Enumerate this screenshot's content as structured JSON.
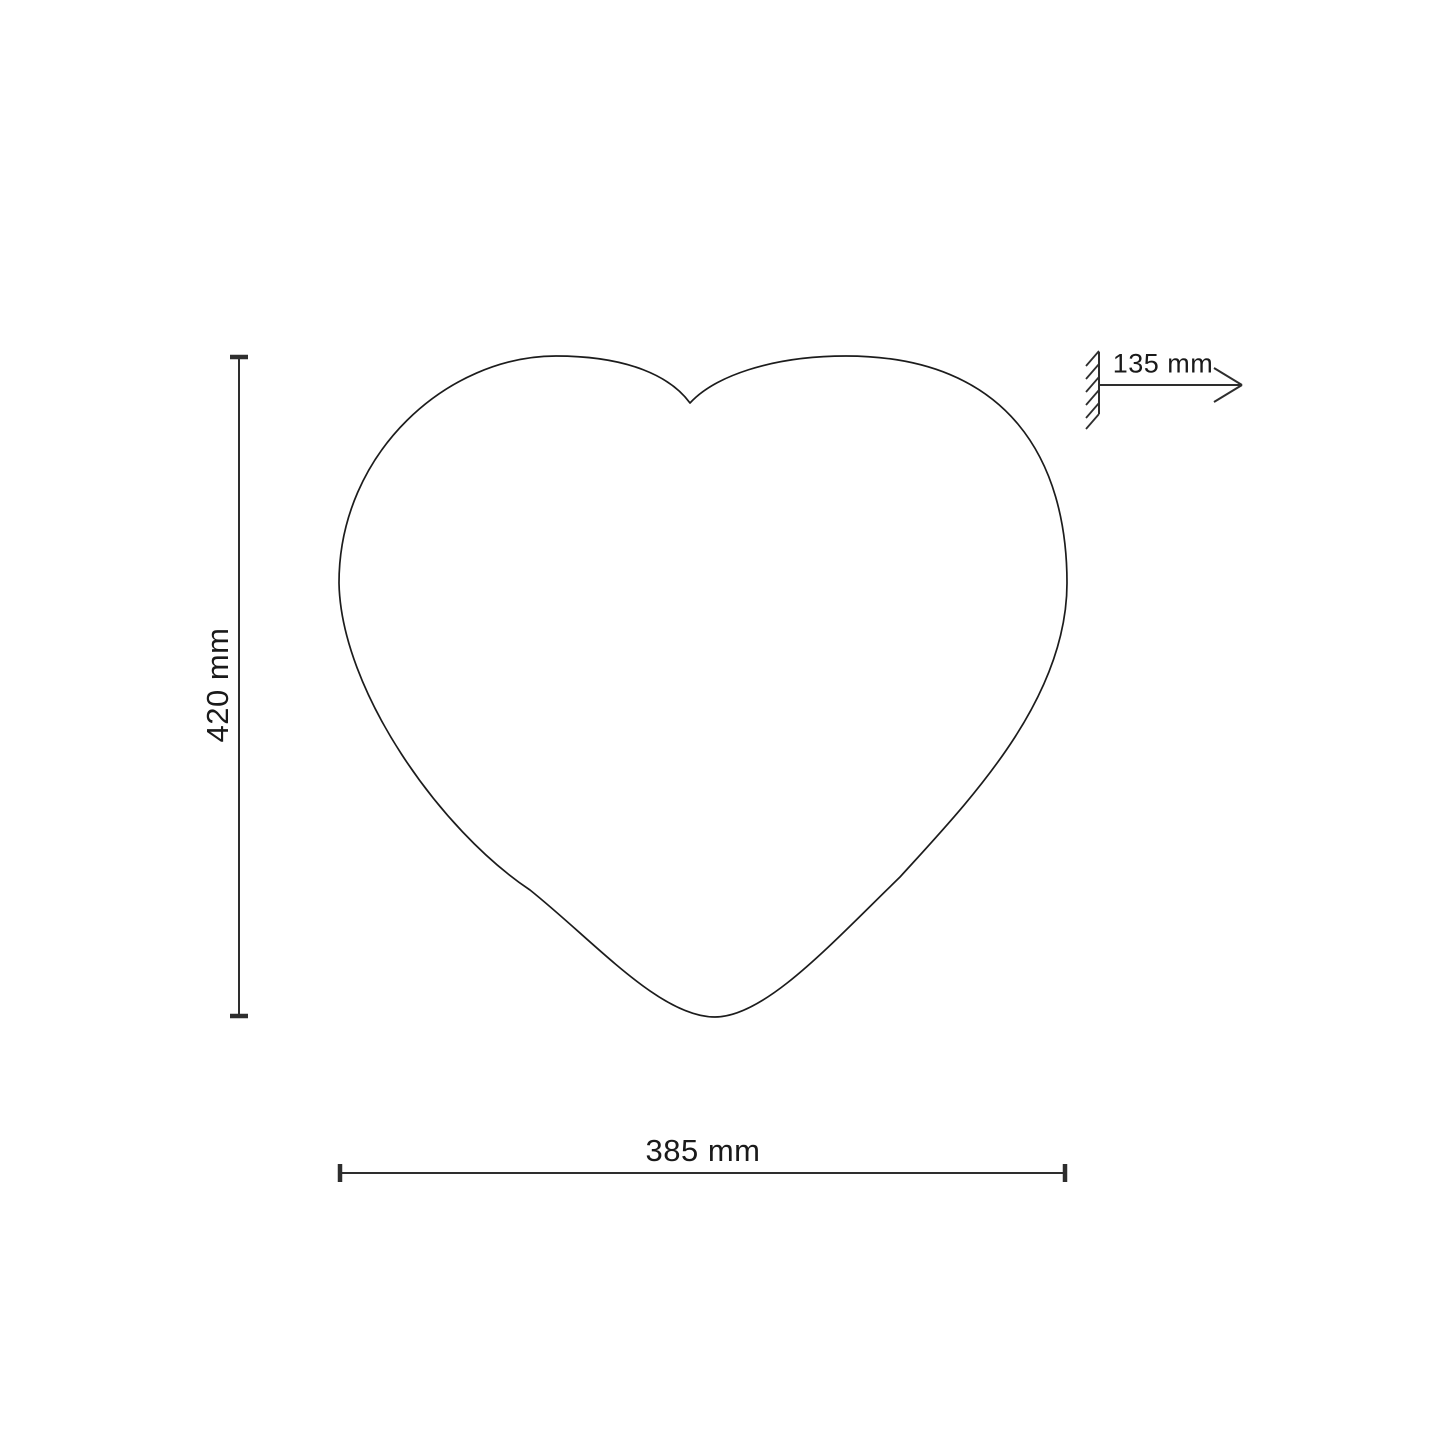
{
  "diagram": {
    "shape": "heart-outline",
    "dimensions": {
      "height": {
        "label": "420 mm",
        "orientation": "vertical"
      },
      "width": {
        "label": "385 mm",
        "orientation": "horizontal"
      },
      "depth": {
        "label": "135 mm",
        "orientation": "horizontal-arrow-from-wall"
      }
    },
    "colors": {
      "background": "#ffffff",
      "outline": "#1c1c1c",
      "dimension_lines": "#2e2e2e",
      "text": "#1a1a1a"
    }
  }
}
